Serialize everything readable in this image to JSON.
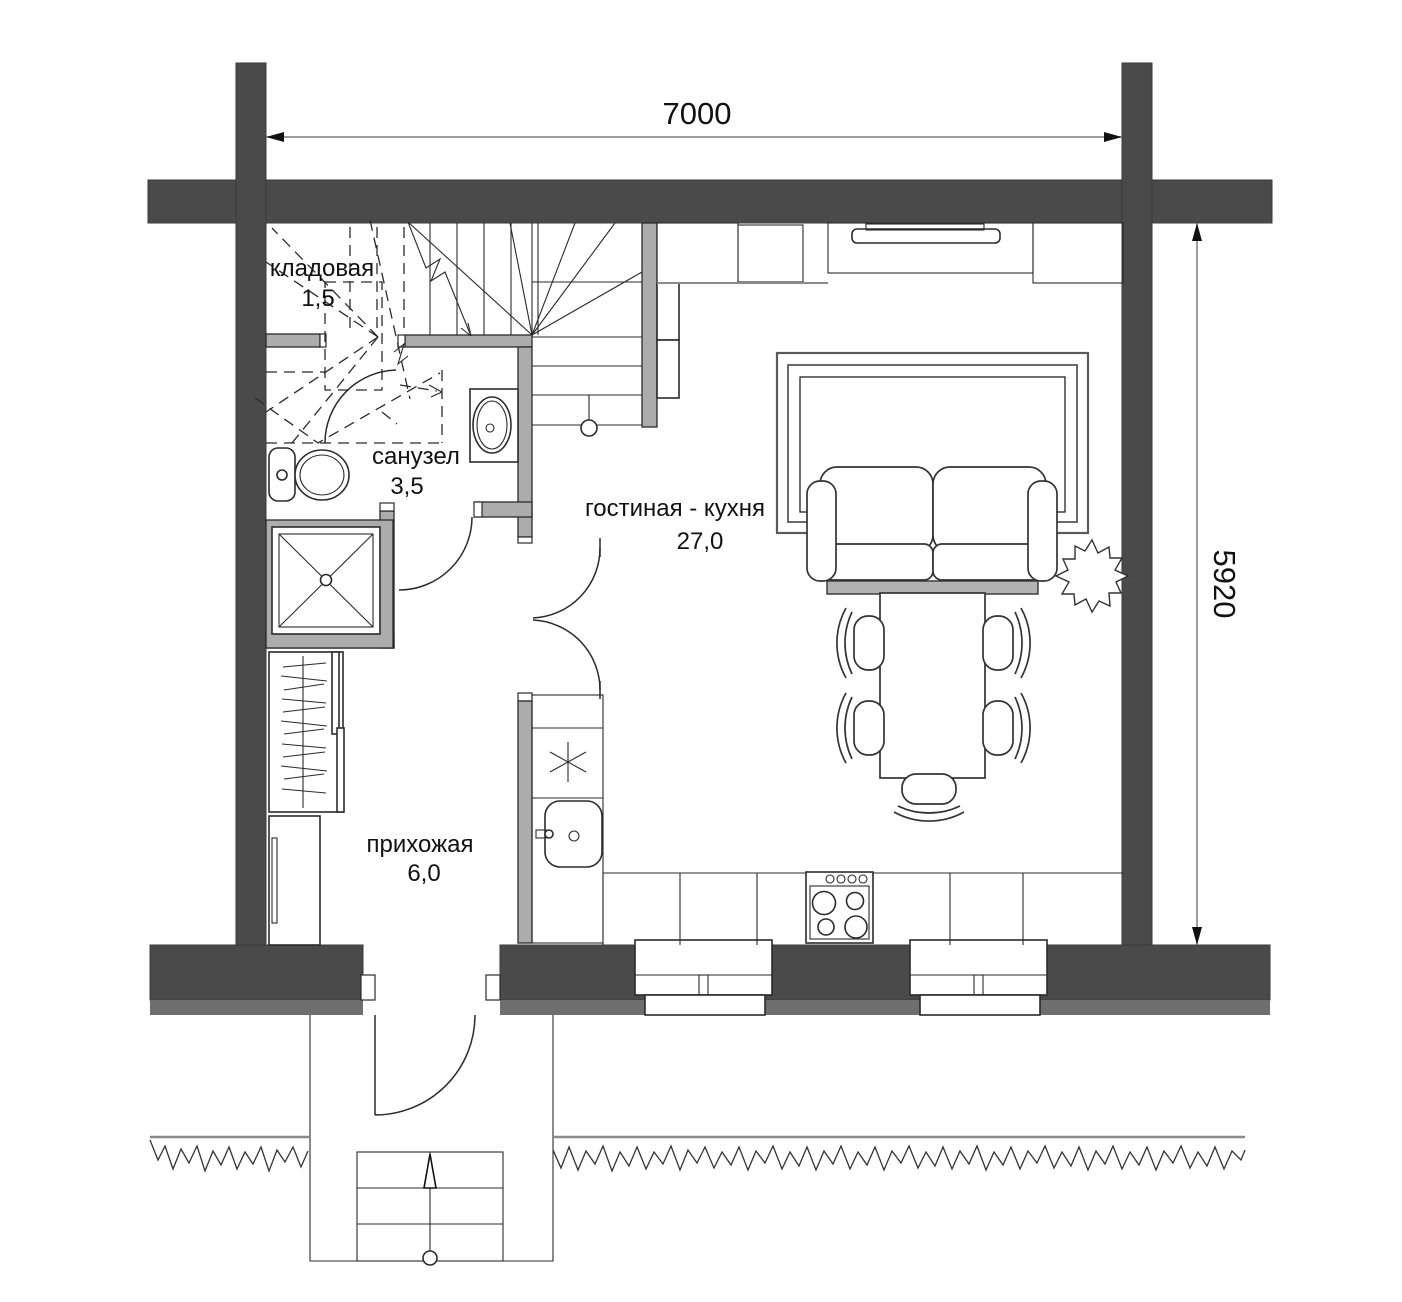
{
  "plan": {
    "dim_width": "7000",
    "dim_height": "5920",
    "rooms": {
      "storage": {
        "name": "кладовая",
        "area": "1,5"
      },
      "bathroom": {
        "name": "санузел",
        "area": "3,5"
      },
      "living_kitchen": {
        "name": "гостиная - кухня",
        "area": "27,0"
      },
      "hallway": {
        "name": "прихожая",
        "area": "6,0"
      }
    },
    "colors": {
      "wall": "#4a4a4a",
      "partition": "#acacac",
      "foundation_band": "#6e6e6e",
      "line": "#2b2b2b",
      "dimension_line": "#7c7c7c",
      "background": "#ffffff"
    }
  }
}
